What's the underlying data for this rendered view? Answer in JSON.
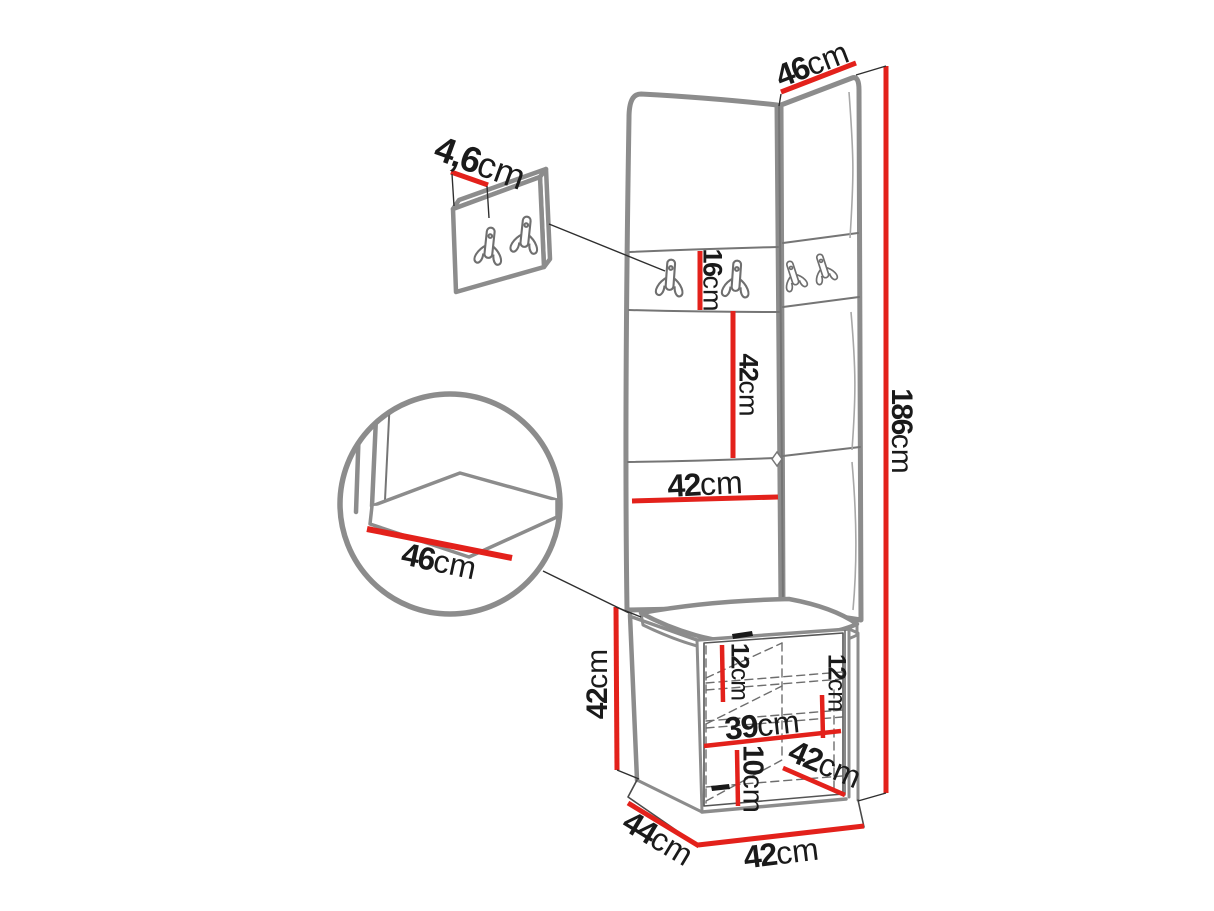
{
  "diagram": {
    "kind": "furniture-dimension-drawing",
    "colors": {
      "dimension_line": "#e3211b",
      "outline_gray": "#8c8c8c",
      "label_text": "#1a1a1a",
      "background": "#ffffff"
    },
    "icons": [
      "coat-hook-icon"
    ]
  },
  "dimensions": {
    "panel_top_width": {
      "value": "46",
      "unit": "cm"
    },
    "hook_panel_thickness": {
      "value": "4,6",
      "unit": "cm"
    },
    "hook_strip_height": {
      "value": "16",
      "unit": "cm"
    },
    "panel_section_height": {
      "value": "42",
      "unit": "cm"
    },
    "panel_width": {
      "value": "42",
      "unit": "cm"
    },
    "seat_depth_detail": {
      "value": "46",
      "unit": "cm"
    },
    "total_height": {
      "value": "186",
      "unit": "cm"
    },
    "cabinet_height": {
      "value": "42",
      "unit": "cm"
    },
    "shelf_gap_left": {
      "value": "12",
      "unit": "cm"
    },
    "shelf_gap_right": {
      "value": "12",
      "unit": "cm"
    },
    "cabinet_inner_width": {
      "value": "39",
      "unit": "cm"
    },
    "plinth_height": {
      "value": "10",
      "unit": "cm"
    },
    "cabinet_depth_right": {
      "value": "42",
      "unit": "cm"
    },
    "cabinet_depth_left": {
      "value": "44",
      "unit": "cm"
    },
    "cabinet_width": {
      "value": "42",
      "unit": "cm"
    }
  }
}
